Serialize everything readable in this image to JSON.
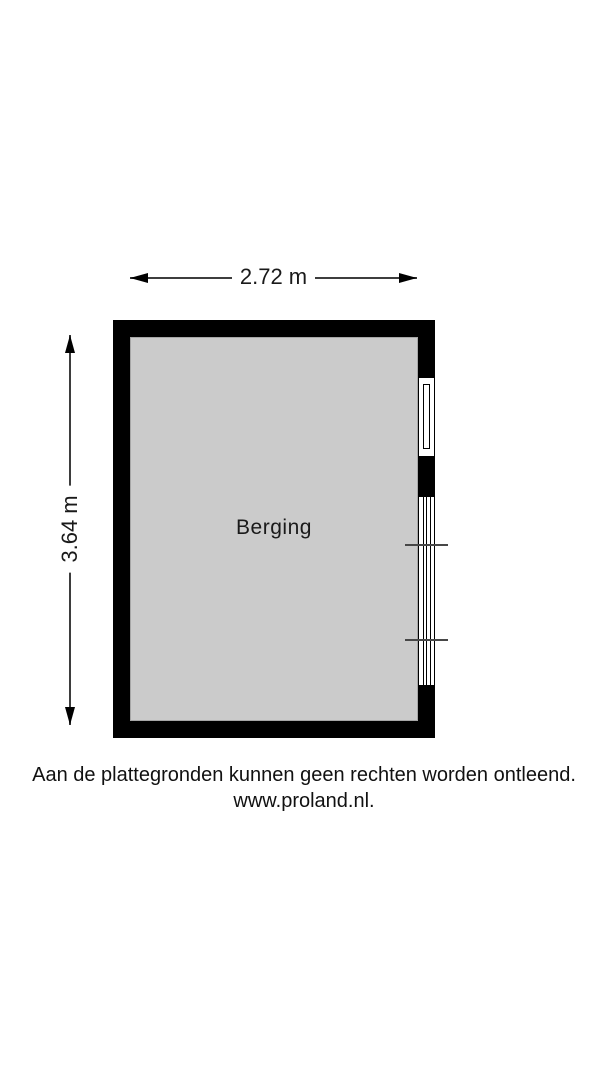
{
  "floorplan": {
    "room": {
      "label": "Berging"
    },
    "dimensions": {
      "width": {
        "label": "2.72 m"
      },
      "height": {
        "label": "3.64 m"
      }
    },
    "features": [
      "small-window-right-wall",
      "large-window-right-wall",
      "sill-ticks"
    ]
  },
  "footer": {
    "disclaimer": "Aan de plattegronden kunnen geen rechten worden ontleend.",
    "website": "www.proland.nl."
  },
  "colors": {
    "wall": "#000000",
    "floor": "#cbcbcb",
    "dimension_line": "#3d3d3d",
    "background": "#ffffff"
  }
}
